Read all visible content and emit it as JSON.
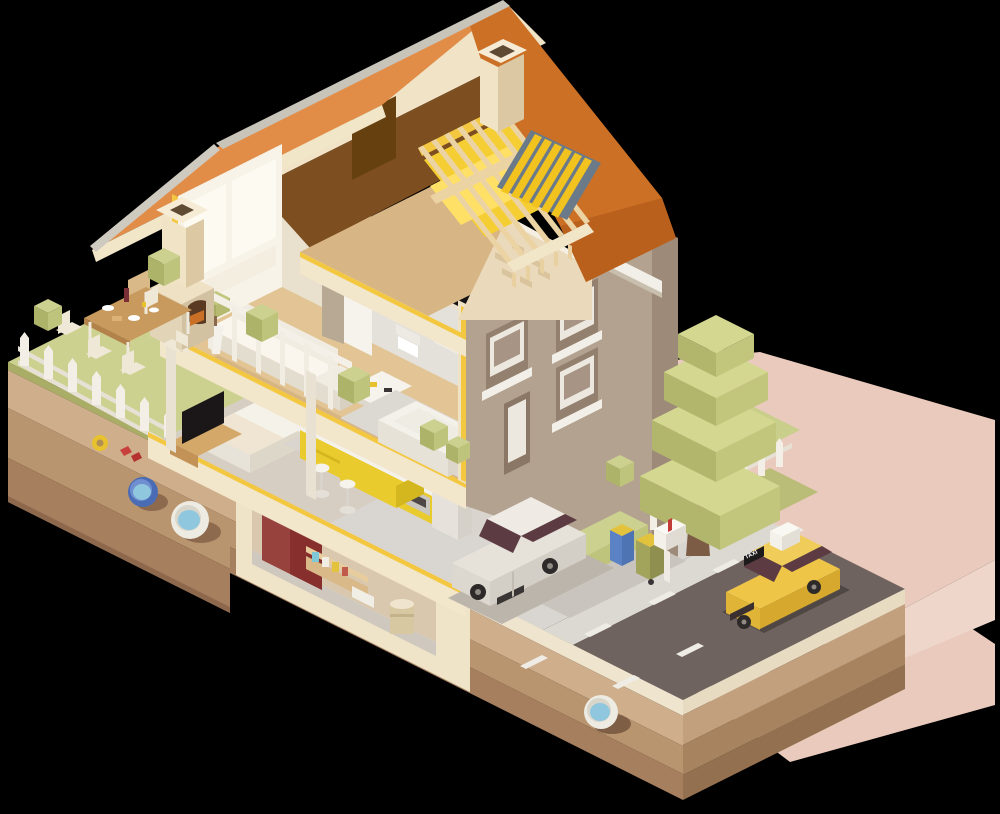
{
  "scene": {
    "title": "Isometric cutaway illustration of a two-story house with garden, street and underground utilities",
    "type": "vector-isometric-diorama",
    "background_color": "#000000"
  },
  "labels": {
    "taxi_roof_plate": "TAXI"
  },
  "palette": {
    "roof_orange_light": "#e18d48",
    "roof_orange_dark": "#cc7026",
    "fascia_cream": "#f2e6c9",
    "ridge_grey": "#c9c4ba",
    "insulation_yellow": "#f5ce33",
    "cut_edge_yellow": "#f3c73f",
    "wall_cream": "#f4ecd8",
    "wall_tan": "#b3a290",
    "wall_tan_dark": "#9d8a78",
    "gable_cream": "#ead9ba",
    "brick": "#d9c49e",
    "floor_tan": "#e2c495",
    "tile_grey": "#d9d4cd",
    "interior_wall": "#e9e0cd",
    "bedroom_wall_brown": "#a98c72",
    "kitchen_yellow": "#e9cb2e",
    "maroon_cupboard": "#97423c",
    "grass_green": "#ccd18f",
    "bush_dark": "#aeb36a",
    "bush_mid": "#bfc47c",
    "soil_band_1": "#cfae8c",
    "soil_band_2": "#b8946f",
    "soil_band_3": "#a67f5e",
    "subbase_cream": "#efe5cf",
    "road_grey": "#6f6360",
    "sidewalk_grey": "#dcd8d2",
    "driveway_grey": "#d9d5d0",
    "marking_white": "#efece5",
    "car_white": "#e6e2da",
    "taxi_yellow": "#eec547",
    "window_tint_maroon": "#5d3b43",
    "pipe_blue": "#4a6cb5",
    "pipe_white": "#edebe2",
    "water_blue": "#8ec7de",
    "bin_blue": "#5b82c4",
    "bin_olive": "#a3a45c",
    "bin_lid_yellow": "#e3c23c",
    "mailbox_white": "#f4f1ea",
    "mailbox_flag_red": "#c33b36",
    "tree_green": "#cdd08d",
    "trunk_brown": "#7c5c45",
    "backdrop_pink": "#e9cabc",
    "attic_void_brown": "#7d4e1f",
    "skylight_frame": "#6b7a88"
  },
  "house": {
    "attic": [
      "exposed-rafters",
      "yellow-insulation",
      "skylight",
      "chimney",
      "attic-floor-slab"
    ],
    "second_floor": {
      "living_room": [
        "glass-wall",
        "potted-plant",
        "corner-sofa",
        "coffee-table",
        "tv",
        "tower-speaker",
        "balcony-railing"
      ],
      "bathroom": [
        "open-door",
        "wall-toilet",
        "sink",
        "bathtub",
        "tiled-walls"
      ]
    },
    "ground_floor": {
      "bedroom": [
        "bed",
        "tv-stand",
        "tv",
        "picture-frames",
        "open-door"
      ],
      "kitchen": [
        "upper-cabinets",
        "counter",
        "cooktop",
        "oven",
        "fridge",
        "island",
        "bar-stools",
        "window"
      ]
    },
    "basement": [
      "red-cupboard",
      "storage-shelf",
      "jars",
      "boxes",
      "barrel",
      "foundation"
    ]
  },
  "exterior": {
    "garden": [
      "lawn",
      "picket-fence",
      "dining-table",
      "chairs",
      "food",
      "bbq-oven",
      "bushes"
    ],
    "yard_right": [
      "lawn",
      "low-poly-tree",
      "picket-fence",
      "hedge",
      "trash-bin-blue",
      "trash-bin-olive",
      "mailbox"
    ],
    "street": [
      "driveway",
      "sidewalk",
      "road",
      "lane-dashes",
      "pink-cast-shadow"
    ],
    "underground": [
      "soil-strata",
      "blue-pipe",
      "white-pipe-left",
      "white-pipe-right",
      "yellow-hose-ring",
      "red-valve"
    ]
  },
  "vehicles": {
    "white_car": {
      "type": "sedan",
      "color": "#e6e2da"
    },
    "taxi": {
      "type": "taxi",
      "color": "#eec547",
      "roof_plate_text": "TAXI",
      "roof_sign": "white-box"
    }
  }
}
